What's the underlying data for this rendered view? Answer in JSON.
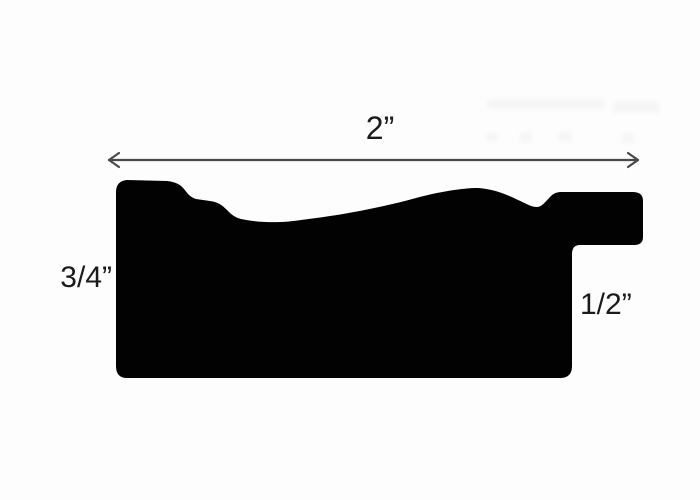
{
  "diagram": {
    "subject": "picture-frame moulding profile cross-section",
    "labels": {
      "width": "2”",
      "height": "3/4”",
      "rabbet": "1/2”"
    },
    "colors": {
      "background": "#fdfdfd",
      "profile": "#020202",
      "arrow": "#4a4a4a",
      "text": "#1b1b1b"
    },
    "geometry": {
      "profile_path": "M 116,192 Q 116,181 127,180 L 167,181 C 175,182 180,184 184,189 C 188,194 190,197 196,199 L 210,201 C 218,202 222,205 227,210 C 231,214 234,217 241,219 C 259,223 283,223 301,220 C 336,216 376,209 416,198 C 438,192 462,188 478,188 C 493,189 506,194 518,200 C 525,203 531,207 537,207 C 542,207 546,201 551,196 Q 555,192 561,192 L 633,192 Q 643,192 643,201 L 643,237 Q 643,245 634,245 L 580,245 Q 572,245 572,254 L 572,366 Q 572,378 560,378 L 127,378 Q 116,378 116,366 Z",
      "arrow_line": {
        "x1": "109",
        "y1": "160",
        "x2": "638",
        "y2": "160"
      },
      "arrow_head_left": "119,153 109,160 119,167",
      "arrow_head_right": "628,153 638,160 628,167"
    }
  }
}
